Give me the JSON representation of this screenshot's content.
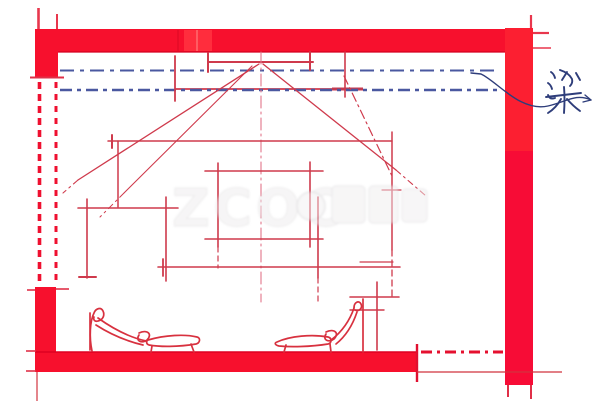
{
  "annotation": {
    "beam_label": "梁",
    "beam_label_color": "#2e3d7a",
    "arrow_icon": "curved-leader-arrow"
  },
  "watermark": {
    "latin": "ZCOO",
    "cjk_visible": "众"
  },
  "colors": {
    "structure_red": "#f7102d",
    "structure_red_light": "#ff2d3d",
    "structure_red_lower_wall": "#f70c36",
    "sketch_crimson": "#cf3a4c",
    "sketch_crimson_light": "#e2758a",
    "beam_blue": "#4a58a0",
    "ink_blue": "#2e3d7a",
    "background": "#ffffff"
  }
}
